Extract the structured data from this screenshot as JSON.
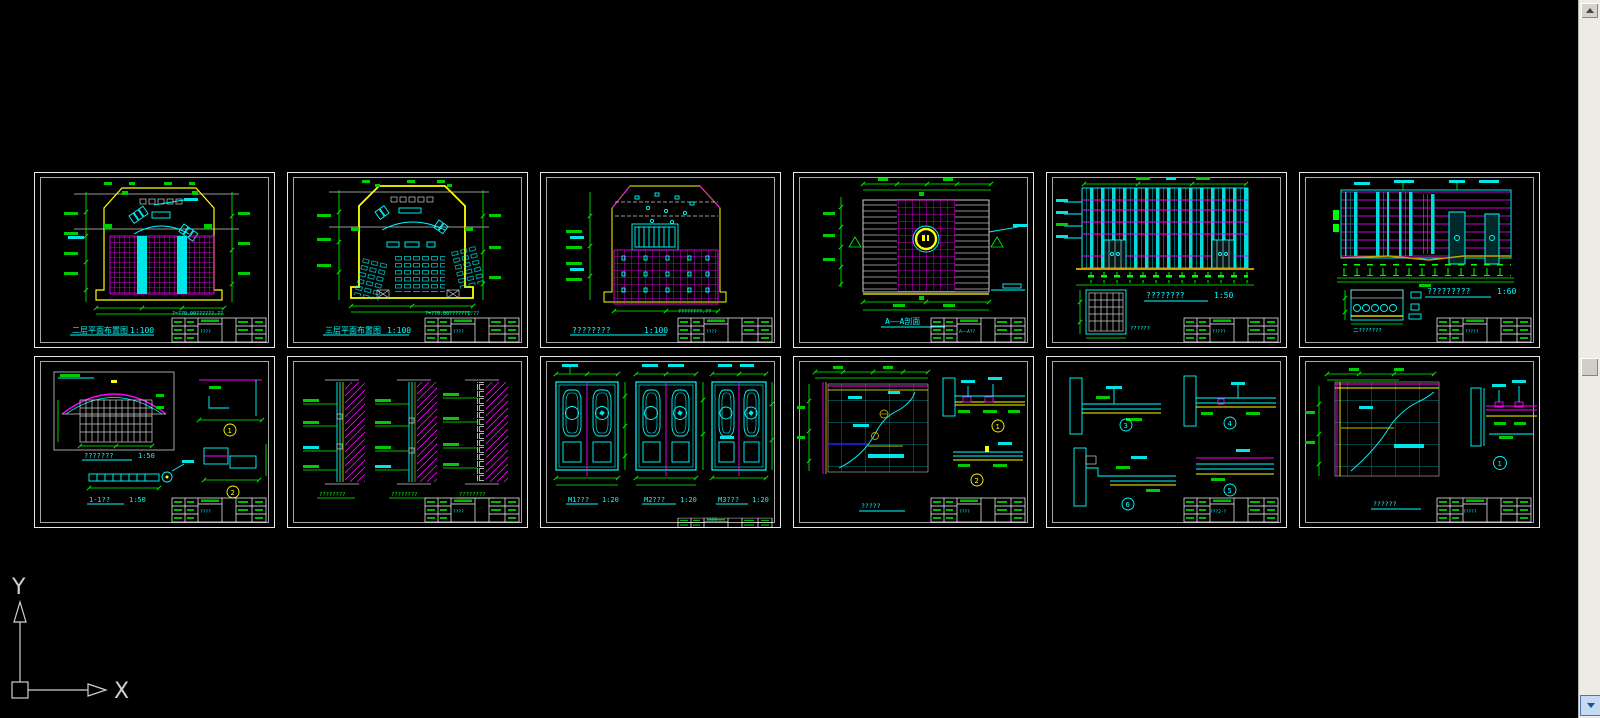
{
  "app": {
    "background": "#000000"
  },
  "colors": {
    "cyan": "#00ffff",
    "magenta": "#ff00ff",
    "green": "#00ff00",
    "yellow": "#ffff00",
    "white": "#ffffff",
    "scroll_button_blue": "#c7daf3"
  },
  "ucs": {
    "x_label": "X",
    "y_label": "Y"
  },
  "sheets": [
    {
      "name": "plan-floor-magenta",
      "title": "二层平面布置图",
      "scale": "1:100",
      "note": "?=??0.00??????.??",
      "titleblock": "????"
    },
    {
      "name": "plan-floor-seating",
      "title": "三层平面布置图",
      "scale": "1:100",
      "note": "?=??0.00??????1.??",
      "titleblock": "????"
    },
    {
      "name": "ceiling-plan",
      "title": "????????",
      "scale": "1:100",
      "note": "????????.??",
      "titleblock": "????"
    },
    {
      "name": "section-a-a",
      "title": "A——A剖面",
      "titleblock": "A——A??"
    },
    {
      "name": "elevation-front",
      "title": "????????",
      "scale": "1:50",
      "sub_label": "??????",
      "titleblock": "?????"
    },
    {
      "name": "elevation-side",
      "title": "?????????",
      "scale": "1:60",
      "sub_label": "二???????",
      "titleblock": "?????"
    },
    {
      "name": "canopy-detail",
      "title": "???????",
      "scale": "1:50",
      "title2": "1-1??",
      "scale2": "1:50",
      "bubbles": [
        "1",
        "2"
      ],
      "titleblock": "????"
    },
    {
      "name": "wall-sections",
      "captions": [
        "????????",
        "????????",
        "????????"
      ],
      "titleblock": "????"
    },
    {
      "name": "door-details",
      "doors": [
        {
          "title": "M1???",
          "scale": "1:20"
        },
        {
          "title": "M2???",
          "scale": "1:20"
        },
        {
          "title": "M3???",
          "scale": "1:20"
        }
      ],
      "titleblock": "????"
    },
    {
      "name": "ceiling-detail-a",
      "title": "?????",
      "bubbles": [
        "1",
        "2"
      ],
      "titleblock": "????"
    },
    {
      "name": "ceiling-details-3-6",
      "bubbles": [
        "3",
        "4",
        "6",
        "5"
      ],
      "titleblock": "???2-?"
    },
    {
      "name": "ceiling-detail-b",
      "title": "??????",
      "bubbles": [
        "1"
      ],
      "titleblock": "?????"
    }
  ]
}
